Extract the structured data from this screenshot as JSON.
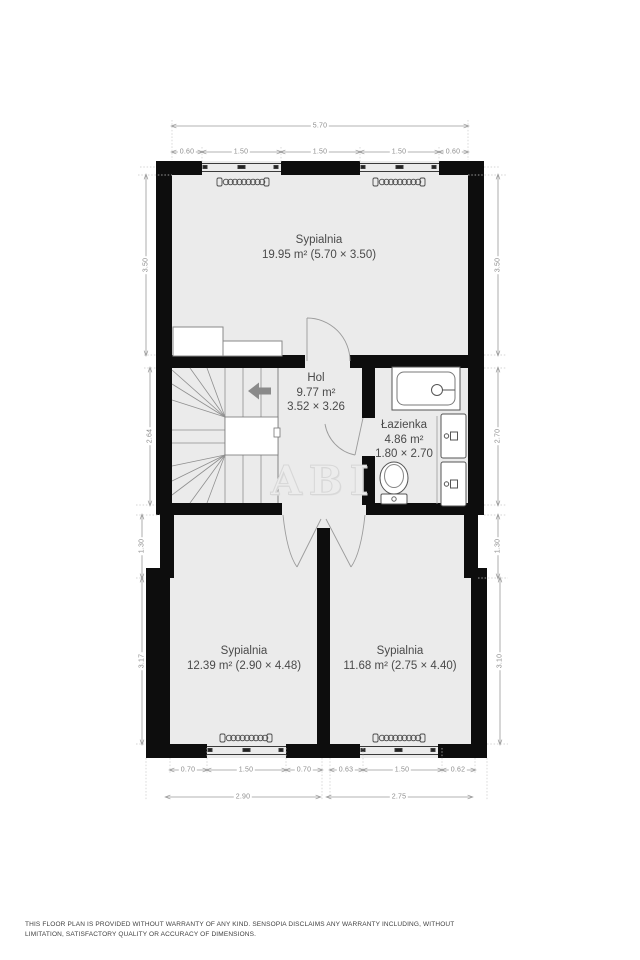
{
  "watermark": "ABI",
  "rooms": {
    "bedroom_top": {
      "name": "Sypialnia",
      "details": "19.95 m² (5.70 × 3.50)"
    },
    "hall": {
      "name": "Hol",
      "area": "9.77 m²",
      "size": "3.52 × 3.26"
    },
    "bathroom": {
      "name": "Łazienka",
      "area": "4.86 m²",
      "size": "1.80 × 2.70"
    },
    "bedroom_left": {
      "name": "Sypialnia",
      "details": "12.39 m² (2.90 × 4.48)"
    },
    "bedroom_right": {
      "name": "Sypialnia",
      "details": "11.68 m² (2.75 × 4.40)"
    }
  },
  "dimensions": {
    "top_overall": "5.70",
    "top_segments": [
      "0.60",
      "1.50",
      "1.50",
      "1.50",
      "0.60"
    ],
    "left_side": [
      "3.50",
      "2.64",
      "1.30",
      "3.17"
    ],
    "right_side": [
      "3.50",
      "2.70",
      "1.30",
      "3.10"
    ],
    "bottom_left_segments": [
      "0.70",
      "1.50",
      "0.70"
    ],
    "bottom_left_overall": "2.90",
    "bottom_right_segments": [
      "0.63",
      "1.50",
      "0.62"
    ],
    "bottom_right_overall": "2.75"
  },
  "disclaimer": "THIS FLOOR PLAN IS PROVIDED WITHOUT WARRANTY OF ANY KIND. SENSOPIA DISCLAIMS ANY WARRANTY INCLUDING, WITHOUT LIMITATION, SATISFACTORY QUALITY OR ACCURACY OF DIMENSIONS.",
  "colors": {
    "wall": "#0d0d0d",
    "floor": "#ebebeb",
    "dimension_gray": "#9a9a9a",
    "room_text": "#4a4a4a",
    "watermark_gray": "#ececec",
    "arrow_gray": "#8a8a8a",
    "background": "#ffffff"
  }
}
